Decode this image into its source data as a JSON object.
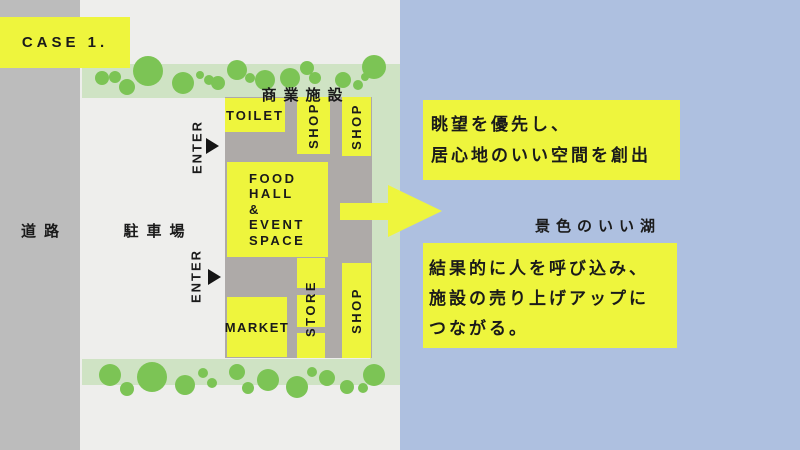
{
  "case_label": "CASE 1.",
  "colors": {
    "accent_yellow": "#eef53d",
    "lake_blue": "#aec0e0",
    "road_gray": "#bcbcbc",
    "plaza_gray": "#aeaaa8",
    "band_green": "#cfe3c4",
    "tree_green": "#7cc455",
    "background": "#eeeeec",
    "text": "#1a1a1a"
  },
  "site": {
    "road_label": "道路",
    "parking_label": "駐車場",
    "facility_label": "商業施設",
    "enter_label": "ENTER",
    "buildings": {
      "toilet": "TOILET",
      "shop_top_inner": "SHOP",
      "shop_top_outer": "SHOP",
      "food_hall": "FOOD\nHALL\n&\nEVENT\nSPACE",
      "market": "MARKET",
      "store": "STORE",
      "shop_bottom": "SHOP"
    },
    "trees": {
      "top": [
        [
          102,
          78,
          7
        ],
        [
          115,
          77,
          6
        ],
        [
          127,
          87,
          8
        ],
        [
          148,
          71,
          15
        ],
        [
          183,
          83,
          11
        ],
        [
          200,
          75,
          4
        ],
        [
          209,
          80,
          5
        ],
        [
          218,
          83,
          7
        ],
        [
          237,
          70,
          10
        ],
        [
          250,
          78,
          5
        ],
        [
          265,
          80,
          10
        ],
        [
          290,
          78,
          10
        ],
        [
          307,
          68,
          7
        ],
        [
          315,
          78,
          6
        ],
        [
          343,
          80,
          8
        ],
        [
          358,
          85,
          5
        ],
        [
          365,
          77,
          4
        ],
        [
          374,
          67,
          12
        ]
      ],
      "bottom": [
        [
          110,
          375,
          11
        ],
        [
          127,
          389,
          7
        ],
        [
          152,
          377,
          15
        ],
        [
          185,
          385,
          10
        ],
        [
          203,
          373,
          5
        ],
        [
          212,
          383,
          5
        ],
        [
          237,
          372,
          8
        ],
        [
          248,
          388,
          6
        ],
        [
          268,
          380,
          11
        ],
        [
          297,
          387,
          11
        ],
        [
          312,
          372,
          5
        ],
        [
          327,
          378,
          8
        ],
        [
          347,
          387,
          7
        ],
        [
          363,
          388,
          5
        ],
        [
          374,
          375,
          11
        ]
      ]
    }
  },
  "lake": {
    "label": "景色のいい湖",
    "callout_top": "眺望を優先し、\n居心地のいい空間を創出",
    "callout_bottom": "結果的に人を呼び込み、\n施設の売り上げアップに\nつながる。"
  }
}
